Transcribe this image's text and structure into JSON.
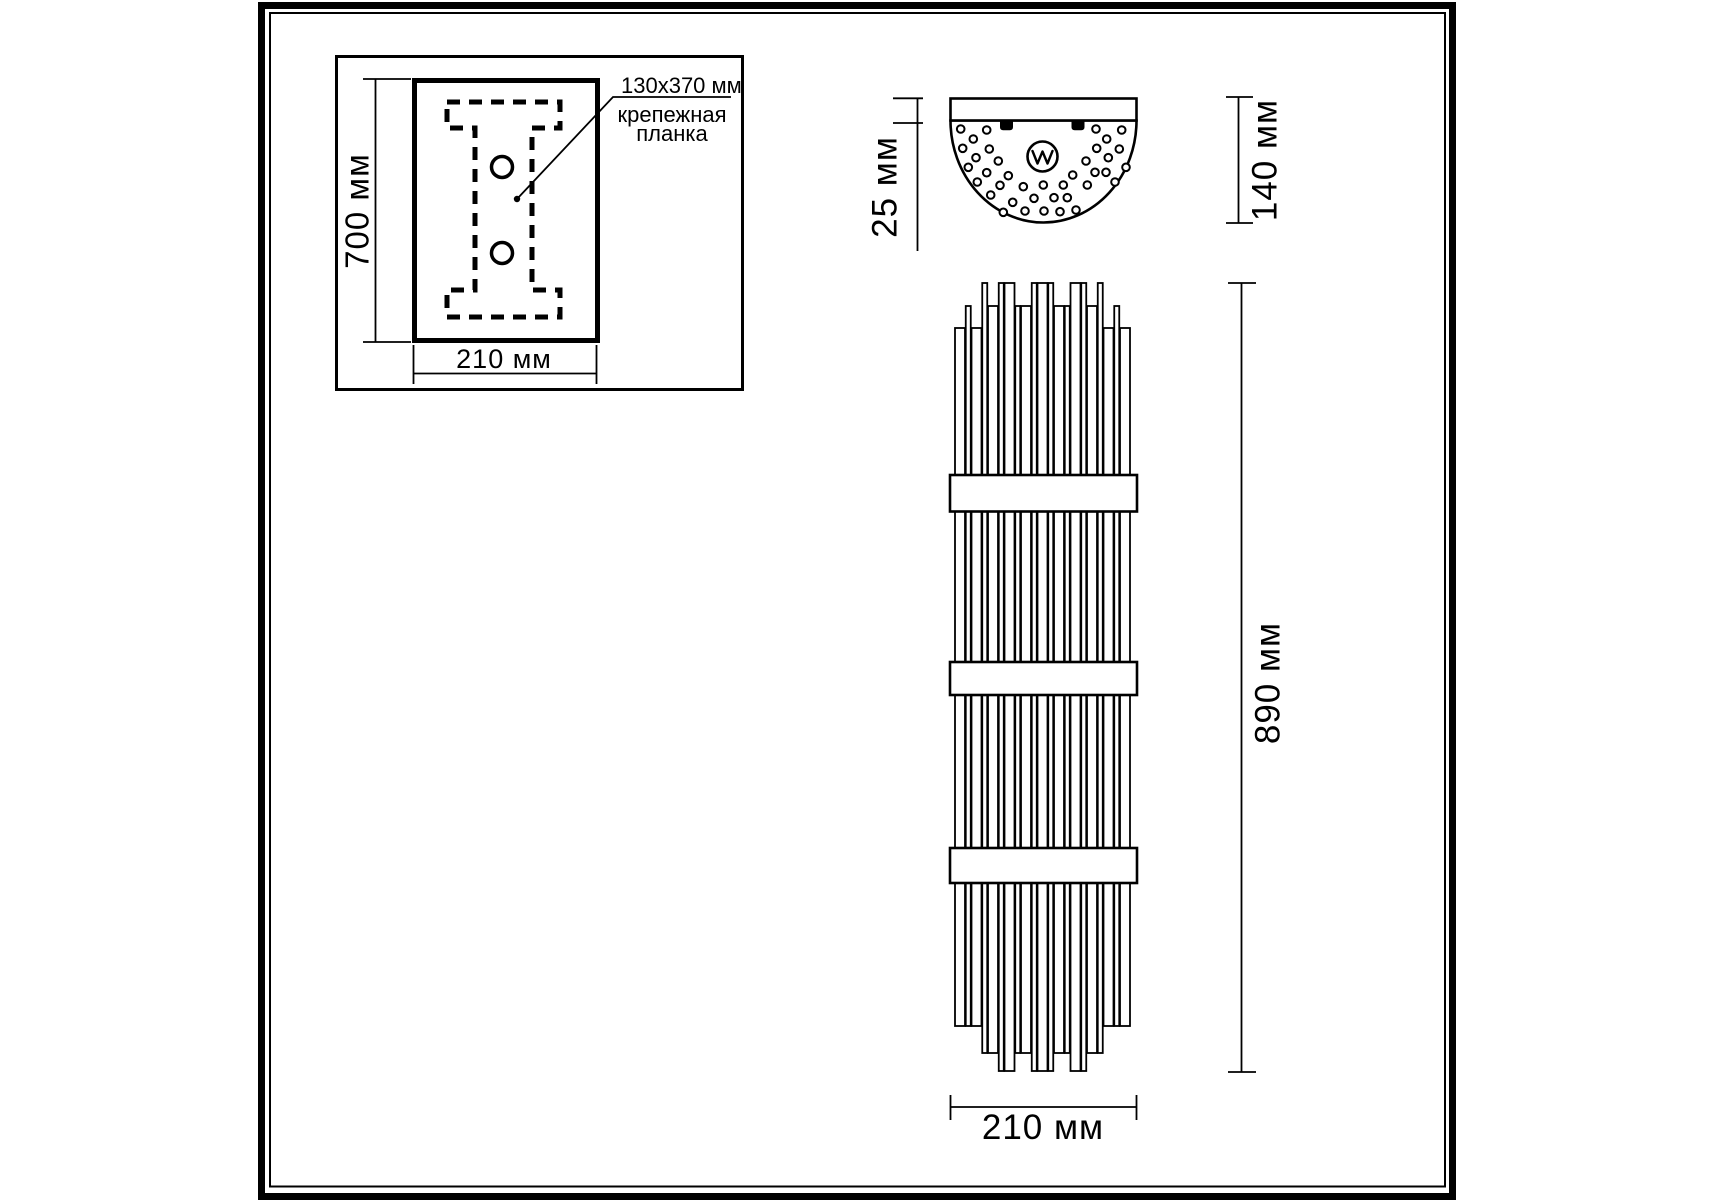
{
  "colors": {
    "line": "#000000",
    "background": "#ffffff"
  },
  "mounting_inset": {
    "height_label": "700 мм",
    "width_label": "210 мм",
    "callout_size": "130x370 мм",
    "callout_name_line1": "крепежная",
    "callout_name_line2": "планка"
  },
  "top_view": {
    "depth_label": "25 мм",
    "height_label": "140 мм",
    "logo_icon": "w-brand-mark"
  },
  "front_view": {
    "height_label": "890 мм",
    "width_label": "210 мм"
  }
}
